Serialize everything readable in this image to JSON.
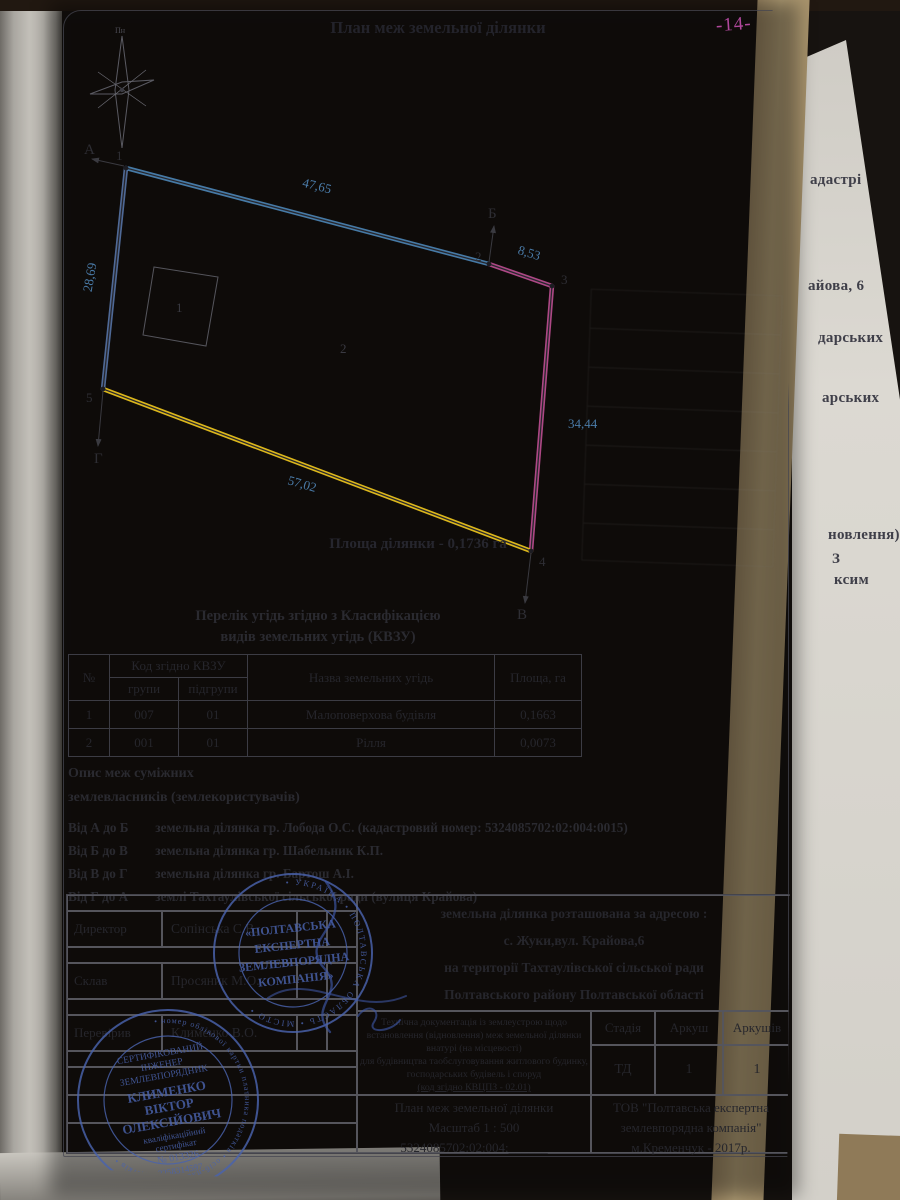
{
  "page_annotation": {
    "number": "-14-"
  },
  "header": {
    "title": "План меж земельної ділянки"
  },
  "compass": {
    "north": "Пн"
  },
  "plan": {
    "area_label": "Площа ділянки - 0,1736 га",
    "parcel_label": "2",
    "building_label": "1",
    "vertices": {
      "v1": "1",
      "v2": "2",
      "v3": "3",
      "v4": "4",
      "v5": "5"
    },
    "directions": {
      "a": "А",
      "b": "Б",
      "v": "В",
      "g": "Г"
    },
    "lengths": {
      "s12": "47,65",
      "s23": "8,53",
      "s34": "34,44",
      "s45": "57,02",
      "s51": "28,69"
    },
    "colors": {
      "s12": "#4d87b8",
      "s23": "#bf4f93",
      "s34": "#bf4f93",
      "s45": "#e8c11c",
      "s51": "#5b7bb0",
      "measure_text": "#4a7ba8"
    }
  },
  "landuse": {
    "title_line1": "Перелік угідь згідно з Класифікацією",
    "title_line2": "видів земельних угідь (КВЗУ)",
    "columns": {
      "num": "№",
      "code": "Код згідно КВЗУ",
      "group": "групи",
      "subgroup": "підгрупи",
      "name": "Назва земельних угідь",
      "area": "Площа, га"
    },
    "rows": [
      {
        "num": "1",
        "group": "007",
        "subgroup": "01",
        "name": "Малоповерхова будівля",
        "area": "0,1663"
      },
      {
        "num": "2",
        "group": "001",
        "subgroup": "01",
        "name": "Рілля",
        "area": "0,0073"
      }
    ]
  },
  "adjacent": {
    "heading_line1": "Опис меж суміжних",
    "heading_line2": "землевласників (землекористувачів)",
    "items": [
      {
        "range": "Від А до Б",
        "desc": "земельна ділянка гр. Лобода О.С. (кадастровий номер: 5324085702:02:004:0015)"
      },
      {
        "range": "Від Б до В",
        "desc": "земельна ділянка гр. Шабельник К.П."
      },
      {
        "range": "Від В до Г",
        "desc": "земельна ділянка гр. Бартош А.І."
      },
      {
        "range": "Від Г до А",
        "desc": "землі Тахтаулівської сільської ради (вулиця Крайова)"
      }
    ]
  },
  "title_block": {
    "roles": [
      {
        "role": "Директор",
        "name": "Сопінська С.В."
      },
      {
        "role": "Склав",
        "name": "Просяник М.О."
      },
      {
        "role": "Перевірив",
        "name": "Клименко В.О."
      }
    ],
    "address_line1": "земельна ділянка розташована за адресою :",
    "address_line2": "с. Жуки,вул. Крайова,6",
    "address_line3": "на території Тахтаулівської сільської ради",
    "address_line4": "Полтавського району Полтавської області",
    "doc_line1": "Технічна документація із землеустрою щодо",
    "doc_line2": "встановлення (відновлення) меж земельної ділянки",
    "doc_line3": "внатурі (на місцевості)",
    "doc_line4": "для будівництва таобслуговування житлового будинку,",
    "doc_line5": "господарських будівель і споруд",
    "doc_line6": "(код згідно КВЦПЗ - 02.01)",
    "stage_header": "Стадія",
    "sheet_header": "Аркуш",
    "sheets_header": "Аркушів",
    "stage_value": "ТД",
    "sheet_value": "1",
    "sheets_value": "1",
    "plan_line1": "План меж земельної ділянки",
    "plan_line2": "Масштаб 1 : 500",
    "plan_line3": "5324085702:02:004:______",
    "company_line1": "ТОВ \"Полтавська експертна",
    "company_line2": "землевпорядна компанія\"",
    "company_line3": "м.Кременчук - 2017р."
  },
  "stamps": {
    "company": {
      "ring_text": "• УКРАЇНА • ПОЛТАВСЬКА ОБЛАСТЬ • МІСТО •",
      "line1": "«ПОЛТАВСЬКА",
      "line2": "ЕКСПЕРТНА",
      "line3": "ЗЕМЛЕВПОРЯДНА",
      "line4": "КОМПАНІЯ»"
    },
    "engineer": {
      "ring_text": "• номер облікової картки платника податків • осіб-платників податків •",
      "line1": "СЕРТИФІКОВАНИЙ",
      "line2": "ІНЖЕНЕР",
      "line3": "ЗЕМЛЕВПОРЯДНИК",
      "line4": "КЛИМЕНКО",
      "line5": "ВІКТОР",
      "line6": "ОЛЕКСІЙОВИЧ",
      "line7": "кваліфікаційний",
      "line8": "сертифікат",
      "line9": "№ 013326",
      "number": "3258314597"
    }
  },
  "edge_fragments": {
    "f1": "адастрі",
    "f2": "айова, 6",
    "f3": "дарських",
    "f4": "арських",
    "f5": "новлення)",
    "f6": "З",
    "f7": "ксим"
  }
}
